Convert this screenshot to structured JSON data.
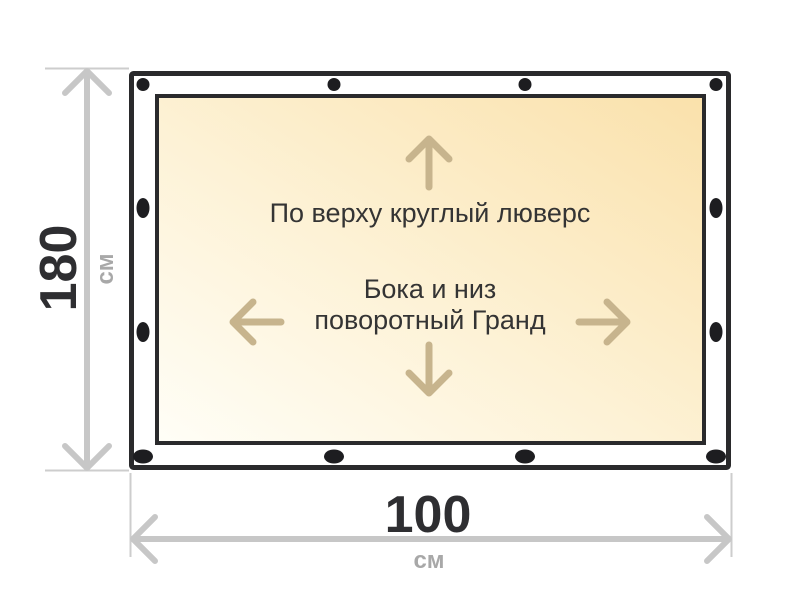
{
  "diagram": {
    "type": "banner-grommet-dimension-diagram",
    "annotations": {
      "top_note": "По верху круглый люверс",
      "center_note_line1": "Бока и низ",
      "center_note_line2": "поворотный Гранд"
    },
    "dimensions": {
      "height": {
        "value": "180",
        "unit": "см"
      },
      "width": {
        "value": "100",
        "unit": "см"
      }
    },
    "grommets": {
      "top_edge_type": "round",
      "sides_and_bottom_type": "oval",
      "top_count": 4,
      "bottom_count": 4,
      "left_side_count": 2,
      "right_side_count": 2
    },
    "icons": {
      "arrow_up": "chevron-line-arrow-up",
      "arrow_down": "chevron-line-arrow-down",
      "arrow_left": "chevron-line-arrow-left",
      "arrow_right": "chevron-line-arrow-right",
      "dimension_arrow_vertical": "double-headed-arrow-vertical",
      "dimension_arrow_horizontal": "double-headed-arrow-horizontal"
    },
    "colors": {
      "frame_border": "#2a2a2c",
      "grommet": "#1d1d20",
      "panel_fill_light": "#fffef7",
      "panel_fill_dark": "#fae1ab",
      "panel_arrow": "#c7b48d",
      "dimension_arrow": "#c7c7c7",
      "extension_line": "#cdcdcd",
      "dimension_value_text": "#2e2e31",
      "dimension_unit_text": "#a8a8a8",
      "annotation_text": "#343434",
      "background": "#ffffff"
    }
  }
}
